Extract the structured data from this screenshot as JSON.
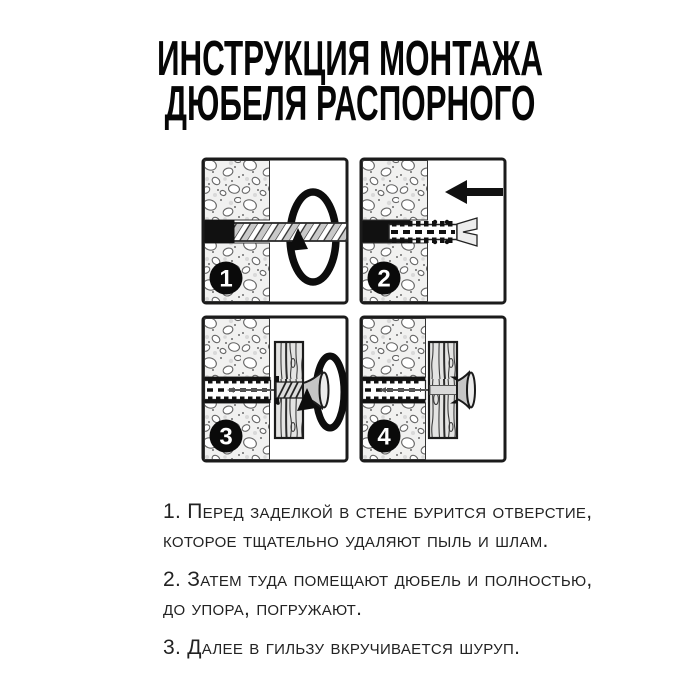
{
  "title": {
    "line1": "ИНСТРУКЦИЯ МОНТАЖА",
    "line2": "ДЮБЕЛЯ РАСПОРНОГО"
  },
  "panels": [
    {
      "number": "1",
      "name": "drill-hole-step",
      "icon": "rotation-arrow"
    },
    {
      "number": "2",
      "name": "insert-dowel-step",
      "icon": "left-arrow"
    },
    {
      "number": "3",
      "name": "screw-in-step",
      "icon": "rotation-arrow"
    },
    {
      "number": "4",
      "name": "finished-step",
      "icon": "none"
    }
  ],
  "instructions": [
    {
      "lines": [
        "1. Перед заделкой в стене бурится отверстие,",
        "которое тщательно удаляют пыль и шлам."
      ]
    },
    {
      "lines": [
        "2. Затем туда помещают дюбель и полностью,",
        "до упора, погружают."
      ]
    },
    {
      "lines": [
        "3. Далее в гильзу вкручивается шуруп."
      ]
    }
  ],
  "colors": {
    "ink": "#111111",
    "panel_border": "#1b1b1b",
    "wall_background": "#f1f1f0",
    "stone_outline": "#666666",
    "metal_gray": "#c6c6c6",
    "wood_grain": "#3d3d3d",
    "background": "#ffffff"
  }
}
